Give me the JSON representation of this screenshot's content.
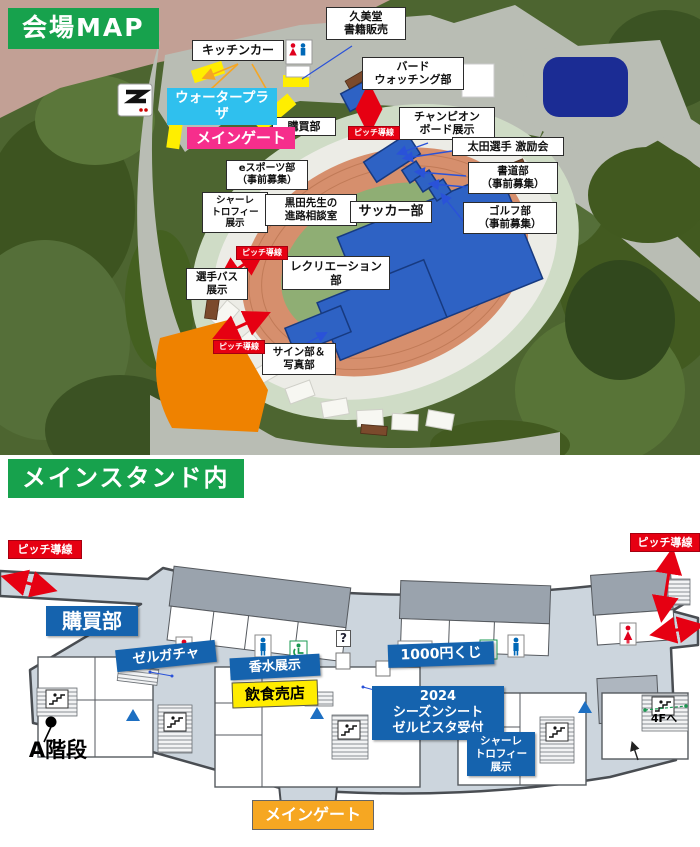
{
  "venue_map": {
    "banner": "会場MAP",
    "labels": {
      "kitchen_car": "キッチンカー",
      "kumido_books": "久美堂\n書籍販売",
      "bird_watching": "バード\nウォッチング部",
      "champion_board": "チャンピオン\nボード展示",
      "ota_support": "太田選手 激励会",
      "calligraphy_club": "書道部\n（事前募集）",
      "golf_club": "ゴルフ部\n（事前募集）",
      "purchasing_dept": "購買部",
      "esports_club": "eスポーツ部\n（事前募集）",
      "schale_trophy": "シャーレ\nトロフィー\n展示",
      "kuroda_room": "黒田先生の\n進路相談室",
      "soccer_club": "サッカー部",
      "recreation_club": "レクリエーション部",
      "player_bus": "選手バス\n展示",
      "sign_photo": "サイン部＆\n写真部",
      "water_plaza": "ウォータープラザ",
      "main_gate": "メインゲート",
      "pitch_route": "ピッチ導線"
    }
  },
  "main_stand": {
    "banner": "メインスタンド内",
    "labels": {
      "pitch_route": "ピッチ導線",
      "purchasing_dept": "購買部",
      "zel_gacha": "ゼルガチャ",
      "perfume_display": "香水展示",
      "lottery_1000yen": "1000円くじ",
      "food_shop": "飲食売店",
      "season_seat_reception": "2024\nシーズンシート\nゼルビスタ受付",
      "schale_trophy": "シャーレ\nトロフィー\n展示",
      "main_gate": "メインゲート",
      "a_stairs": "A階段",
      "to_4f": "4Fへ",
      "info_mark": "?"
    }
  },
  "icons": {
    "info_mark": "?",
    "up_triangle": "▲",
    "pitch_route_arrow": "double-red-arrow",
    "restroom_female": "red-person",
    "restroom_male": "blue-person",
    "accessible_restroom": "green-wheelchair",
    "stairs": "steps-glyph"
  },
  "colors": {
    "banner_green": "#17a24d",
    "badge_red": "#e60012",
    "water_plaza_cyan": "#2fc0ee",
    "main_gate_pink": "#f62e8c",
    "stand_label_blue": "#1563ae",
    "food_shop_yellow": "#ffec00",
    "gate_orange": "#f6a722",
    "pitch_cover_blue": "#2e62c4",
    "track_salmon": "#d68f6d",
    "pond_navy": "#1b2c94"
  }
}
